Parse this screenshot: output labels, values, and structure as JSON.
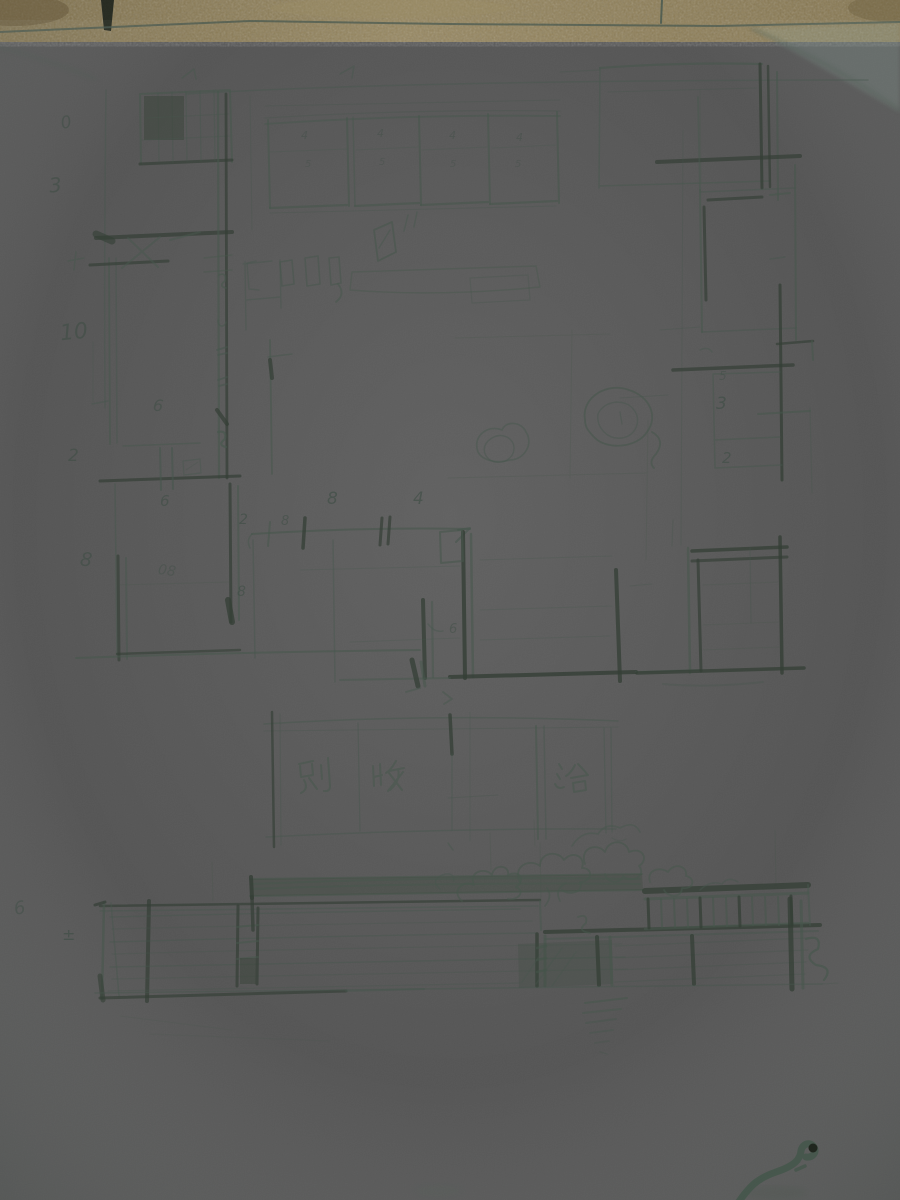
{
  "colors": {
    "table_surface": "#8b7b53",
    "paper": "#bcd3ca",
    "pencil": "#47574d",
    "pencil_dark": "#343f36",
    "wire_object": "#20261e"
  },
  "handwritten_characters": [
    {
      "char": "别",
      "x": 300,
      "y": 760
    },
    {
      "char": "收",
      "x": 374,
      "y": 760
    },
    {
      "char": "浴",
      "x": 556,
      "y": 760
    }
  ],
  "annotations": [
    {
      "t": "0",
      "x": 61,
      "y": 115,
      "s": 17,
      "r": -12,
      "o": 0.5
    },
    {
      "t": "3",
      "x": 49,
      "y": 175,
      "s": 20,
      "r": -6,
      "o": 0.55
    },
    {
      "t": "10",
      "x": 60,
      "y": 322,
      "s": 22,
      "r": -6,
      "o": 0.55
    },
    {
      "t": "2",
      "x": 68,
      "y": 448,
      "s": 17,
      "r": 0,
      "o": 0.55
    },
    {
      "t": "8",
      "x": 80,
      "y": 551,
      "s": 19,
      "r": 6,
      "o": 0.55
    },
    {
      "t": "6",
      "x": 14,
      "y": 900,
      "s": 18,
      "r": -10,
      "o": 0.45
    },
    {
      "t": "±",
      "x": 62,
      "y": 927,
      "s": 16,
      "r": 0,
      "o": 0.6
    },
    {
      "t": "6",
      "x": 153,
      "y": 398,
      "s": 16,
      "r": 8,
      "o": 0.5
    },
    {
      "t": "6",
      "x": 160,
      "y": 494,
      "s": 15,
      "r": 0,
      "o": 0.55
    },
    {
      "t": "08",
      "x": 158,
      "y": 564,
      "s": 14,
      "r": 8,
      "o": 0.38
    },
    {
      "t": "2",
      "x": 239,
      "y": 513,
      "s": 14,
      "r": 0,
      "o": 0.6
    },
    {
      "t": "8",
      "x": 281,
      "y": 515,
      "s": 13,
      "r": 0,
      "o": 0.5
    },
    {
      "t": "8",
      "x": 327,
      "y": 491,
      "s": 17,
      "r": 0,
      "o": 0.6
    },
    {
      "t": "4",
      "x": 413,
      "y": 491,
      "s": 17,
      "r": 0,
      "o": 0.6
    },
    {
      "t": "8",
      "x": 237,
      "y": 585,
      "s": 14,
      "r": 0,
      "o": 0.55
    },
    {
      "t": "6",
      "x": 449,
      "y": 623,
      "s": 13,
      "r": 0,
      "o": 0.45
    },
    {
      "t": "4",
      "x": 301,
      "y": 130,
      "s": 11,
      "r": 0,
      "o": 0.4
    },
    {
      "t": "4",
      "x": 377,
      "y": 128,
      "s": 11,
      "r": 0,
      "o": 0.4
    },
    {
      "t": "4",
      "x": 449,
      "y": 130,
      "s": 11,
      "r": 0,
      "o": 0.4
    },
    {
      "t": "4",
      "x": 516,
      "y": 132,
      "s": 11,
      "r": 0,
      "o": 0.4
    },
    {
      "t": "5",
      "x": 305,
      "y": 160,
      "s": 10,
      "r": 0,
      "o": 0.32
    },
    {
      "t": "5",
      "x": 379,
      "y": 158,
      "s": 10,
      "r": 0,
      "o": 0.32
    },
    {
      "t": "5",
      "x": 450,
      "y": 160,
      "s": 10,
      "r": 0,
      "o": 0.32
    },
    {
      "t": "5",
      "x": 515,
      "y": 160,
      "s": 10,
      "r": 0,
      "o": 0.32
    },
    {
      "t": "5",
      "x": 719,
      "y": 370,
      "s": 12,
      "r": 0,
      "o": 0.42
    },
    {
      "t": "3",
      "x": 716,
      "y": 396,
      "s": 17,
      "r": 0,
      "o": 0.6
    },
    {
      "t": "2",
      "x": 722,
      "y": 451,
      "s": 15,
      "r": 0,
      "o": 0.55
    }
  ]
}
